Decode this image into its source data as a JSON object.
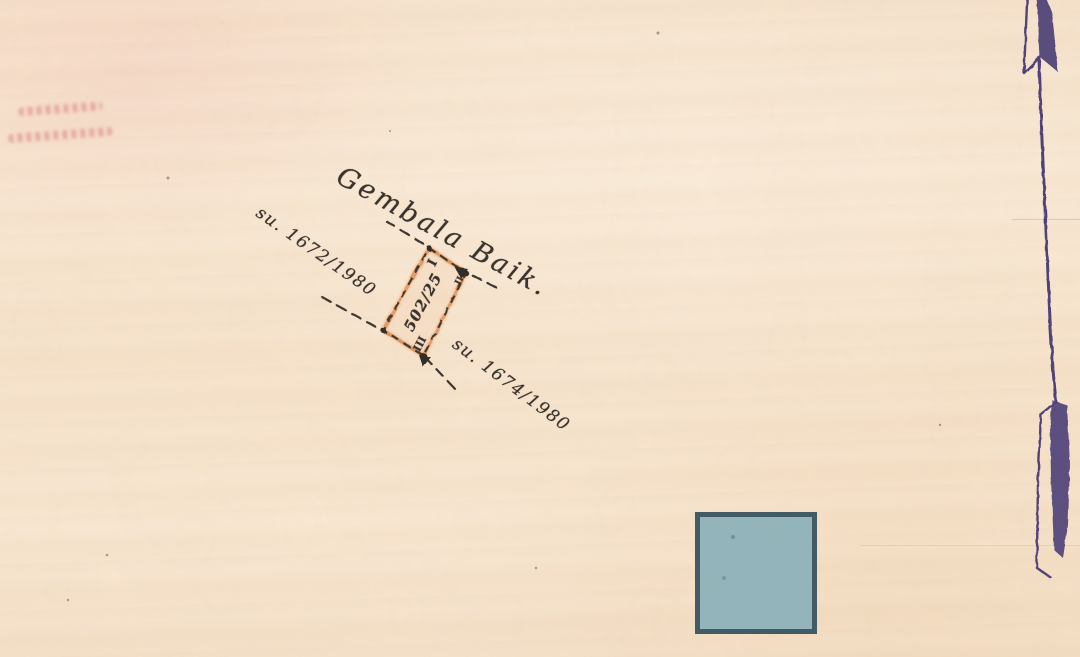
{
  "sketch": {
    "road_name": "Gembala Baik.",
    "boundary_left_label": "su. 1672/1980",
    "boundary_right_label": "su. 1674/1980",
    "plot": {
      "number": "502/25",
      "beacon_top": "I",
      "beacon_right": "II",
      "beacon_bottom": "III"
    }
  },
  "colors": {
    "paper": "#f8e6d0",
    "ink": "#3a342d",
    "plot_outline": "#e29664",
    "plot_outline_halo": "#f3c9a0",
    "north_arrow": "#4d4179",
    "stamp": "#d98b90",
    "square_fill": "#92b5bc",
    "square_border": "#3e5966"
  }
}
